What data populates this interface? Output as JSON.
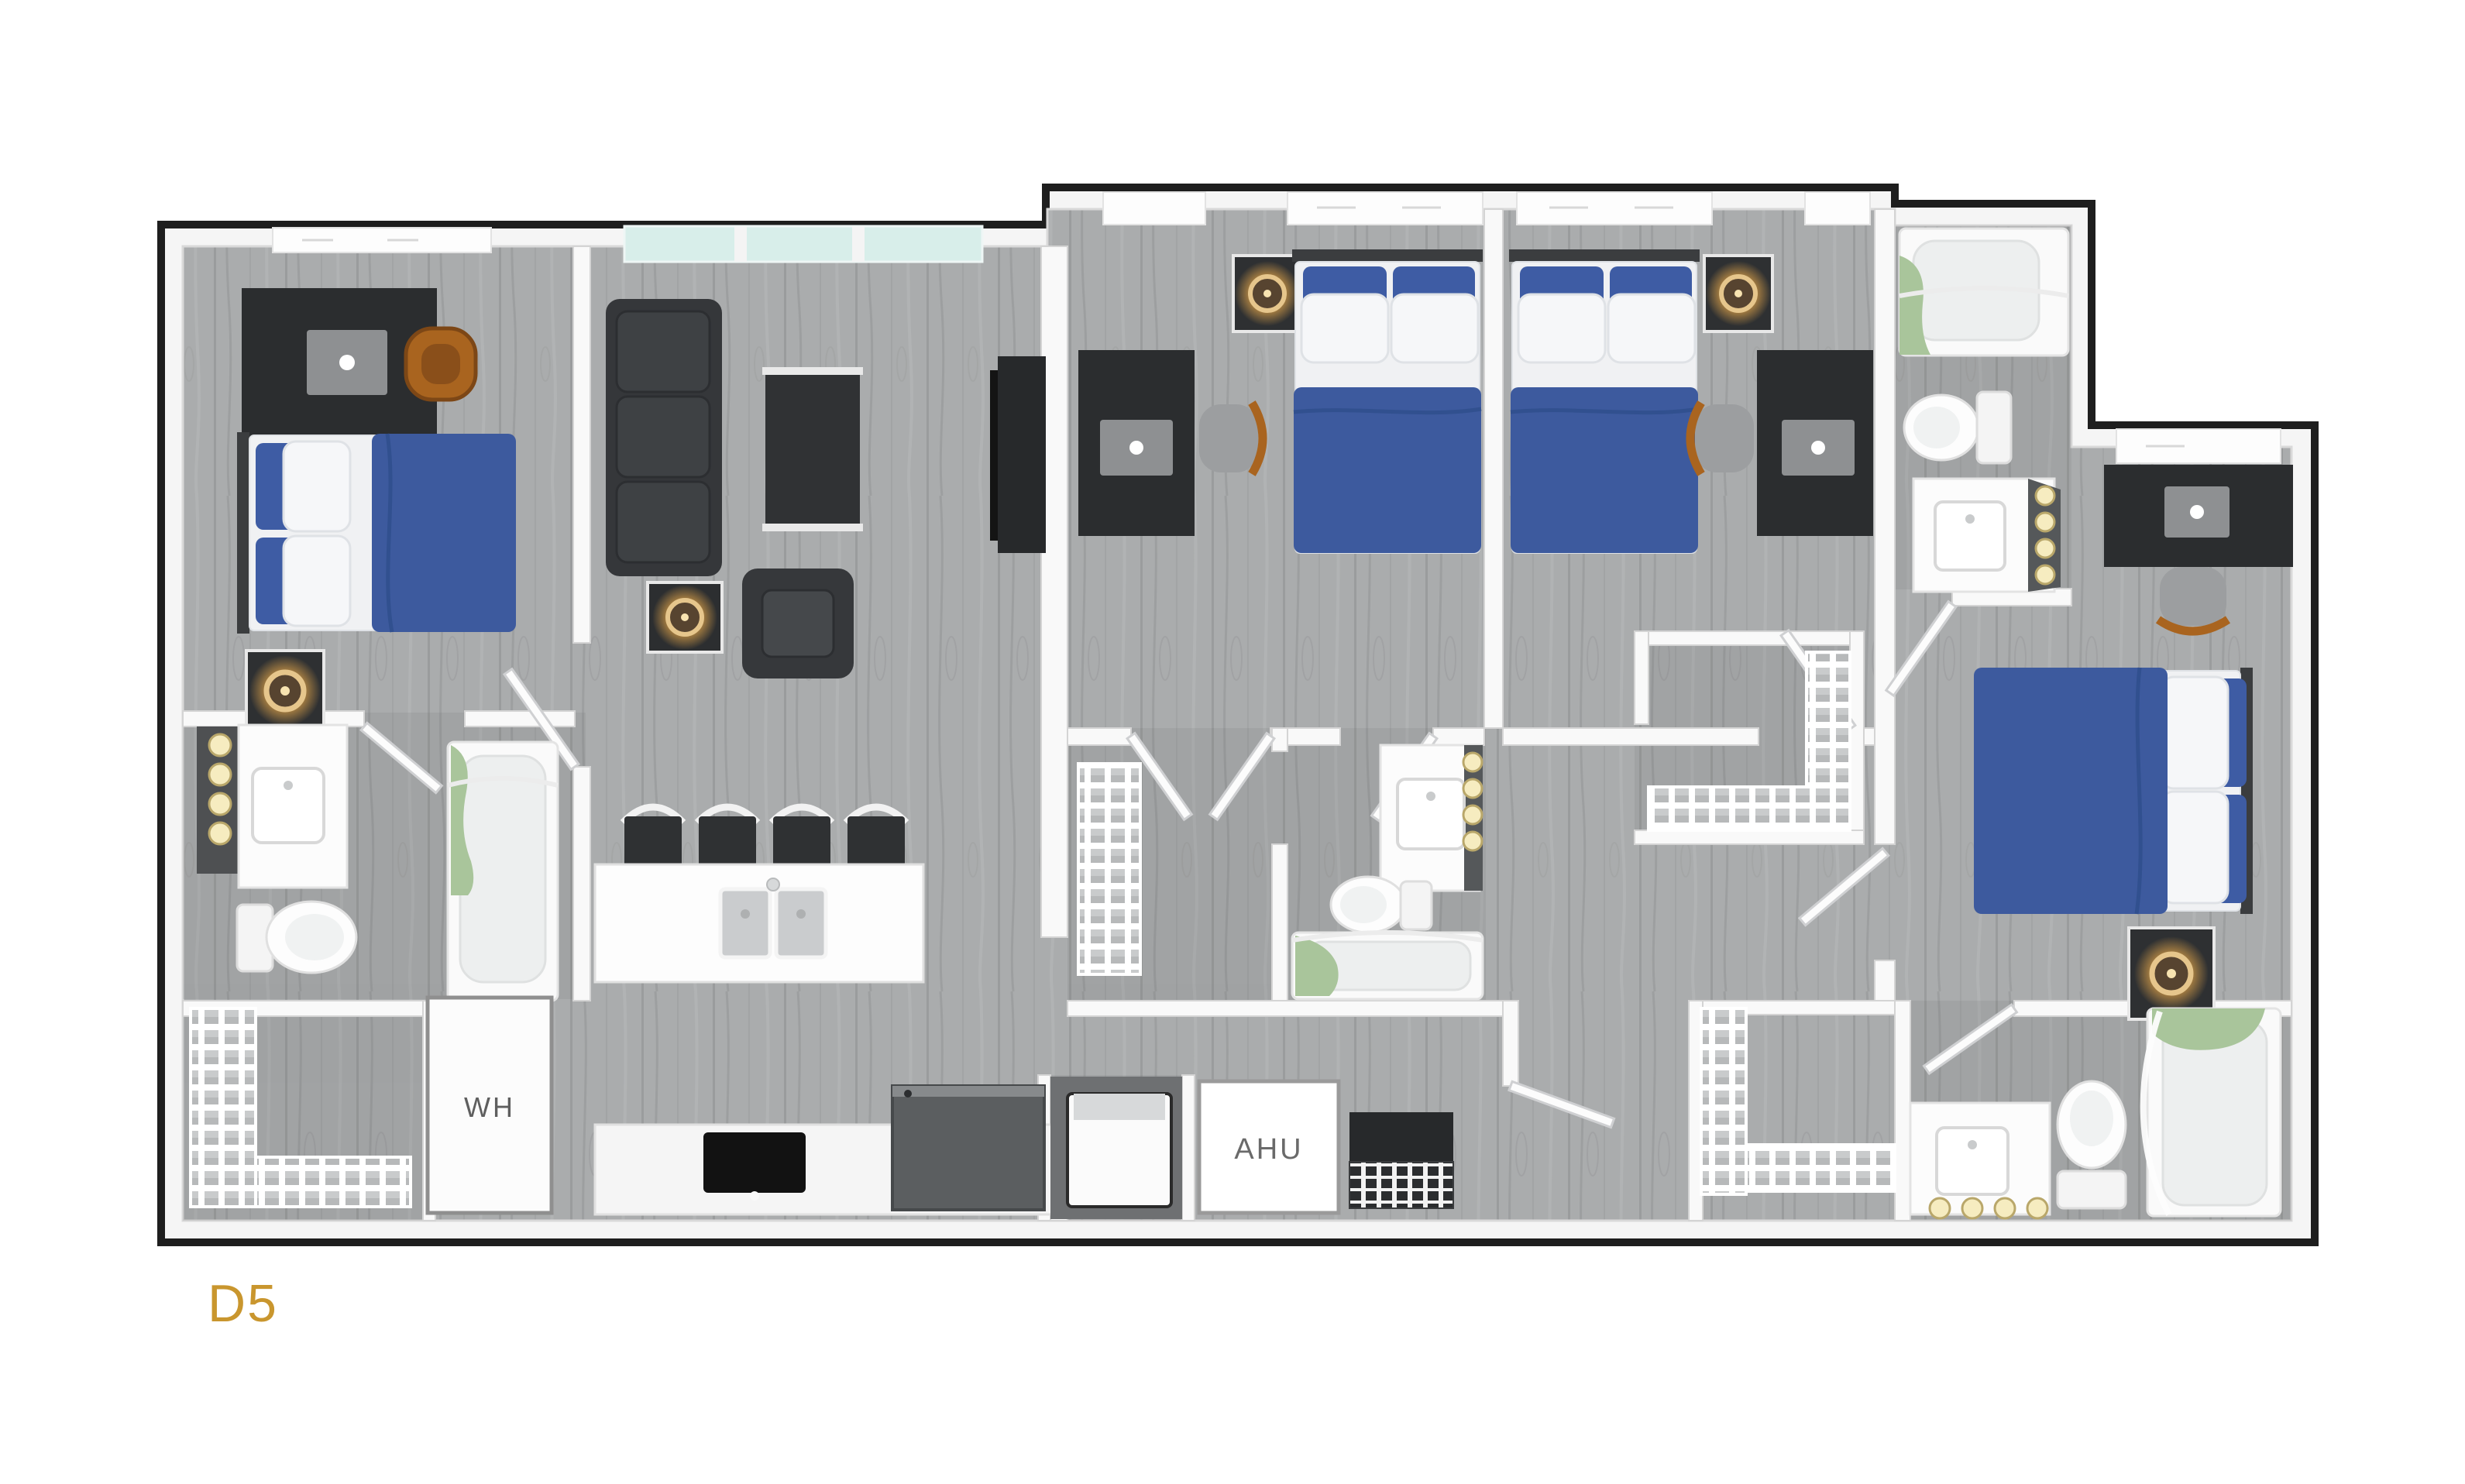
{
  "labels": {
    "unit": "D5",
    "water_heater": "WH",
    "air_handling_unit": "AHU"
  },
  "palette": {
    "outline": "#1E1E1E",
    "wall_white": "#F8F8F8",
    "floor_gray": "#A9ABAC",
    "bed_blue": "#3D5A9E",
    "linen_white": "#F2F3F5",
    "furniture_dark": "#2F3133",
    "wood_chair": "#A9641F",
    "towel_green": "#A9C59B",
    "window_teal": "#D8EEEA",
    "lamp_glow": "#F3B04C",
    "unit_label_gold": "#C9962E",
    "closet_label_gray": "#6A6A6A"
  }
}
